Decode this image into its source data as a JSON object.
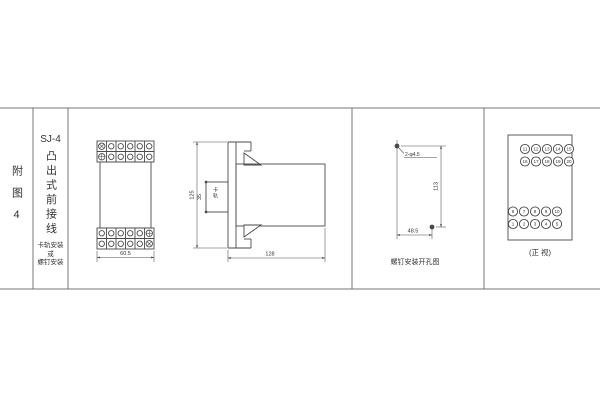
{
  "colors": {
    "line": "#4a4a4a",
    "grid_line": "#777777",
    "background": "#ffffff",
    "text": "#333333"
  },
  "title_block": {
    "figure_label": "附图4",
    "model": "SJ-4",
    "type_name": "凸出式前接线",
    "mounting_line1": "卡轨安装",
    "mounting_line2": "或",
    "mounting_line3": "螺钉安装"
  },
  "front_view": {
    "width_dim": "60.5"
  },
  "side_view": {
    "height_dim": "125",
    "slot_dim": "35",
    "slot_label": "卡轨",
    "depth_dim": "128"
  },
  "drill_view": {
    "holes_label": "2-φ4.5",
    "height_dim": "113",
    "width_dim": "48.5",
    "caption": "螺钉安装开孔图"
  },
  "terminal_view": {
    "caption": "(正 视)",
    "top_row1": [
      "11",
      "12",
      "13",
      "14",
      "15"
    ],
    "top_row2": [
      "16",
      "17",
      "18",
      "19",
      "20"
    ],
    "bottom_row1": [
      "6",
      "7",
      "8",
      "9",
      "10"
    ],
    "bottom_row2": [
      "1",
      "2",
      "3",
      "4",
      "5"
    ]
  }
}
